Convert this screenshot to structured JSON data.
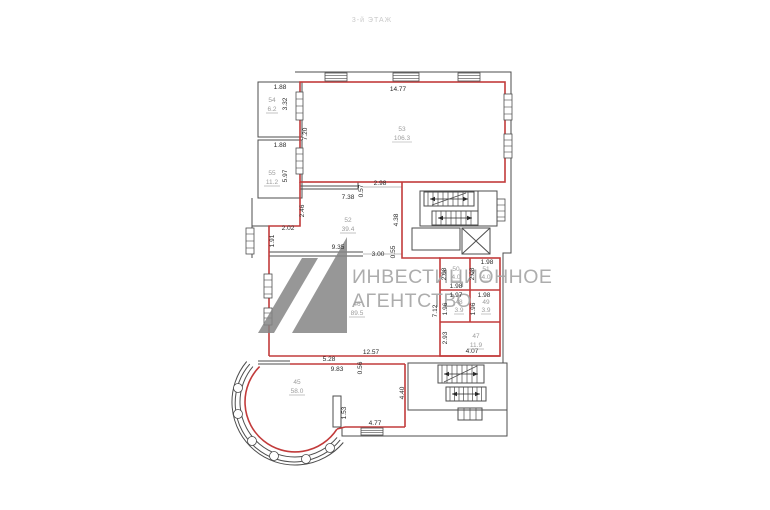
{
  "meta": {
    "floor_label": "3-й ЭТАЖ"
  },
  "watermark": {
    "line1": "ИНВЕСТИЦИОННОЕ",
    "line2": "АГЕНТСТВО"
  },
  "colors": {
    "wall_red": "#c23b3b",
    "wall_gray": "#4d4d4d",
    "dimension_text": "#2a2a2a",
    "room_label": "#9c9c9c",
    "watermark_text": "#a5a5a5",
    "watermark_logo": "#858585",
    "title_text": "#c9c9c9"
  },
  "rooms": [
    {
      "number": "54",
      "area": "6.2"
    },
    {
      "number": "55",
      "area": "11.2"
    },
    {
      "number": "53",
      "area": "106.3"
    },
    {
      "number": "52",
      "area": "39.4"
    },
    {
      "number": "50",
      "area": "4.0"
    },
    {
      "number": "51",
      "area": "4.0"
    },
    {
      "number": "48",
      "area": "3.9"
    },
    {
      "number": "49",
      "area": "3.9"
    },
    {
      "number": "47",
      "area": "11.9"
    },
    {
      "number": "46",
      "area": "89.5"
    },
    {
      "number": "45",
      "area": "58.0"
    }
  ],
  "dims": [
    "1.88",
    "3.32",
    "1.88",
    "5.97",
    "14.77",
    "7.20",
    "2.98",
    "0.57",
    "7.38",
    "2.46",
    "2.02",
    "1.91",
    "9.35",
    "3.00",
    "0.55",
    "4.38",
    "1.98",
    "2.08",
    "2.08",
    "1.98",
    "1.97",
    "1.98",
    "1.96",
    "1.96",
    "7.12",
    "2.93",
    "4.07",
    "12.57",
    "5.28",
    "9.83",
    "0.56",
    "1.53",
    "4.77",
    "4.40"
  ]
}
